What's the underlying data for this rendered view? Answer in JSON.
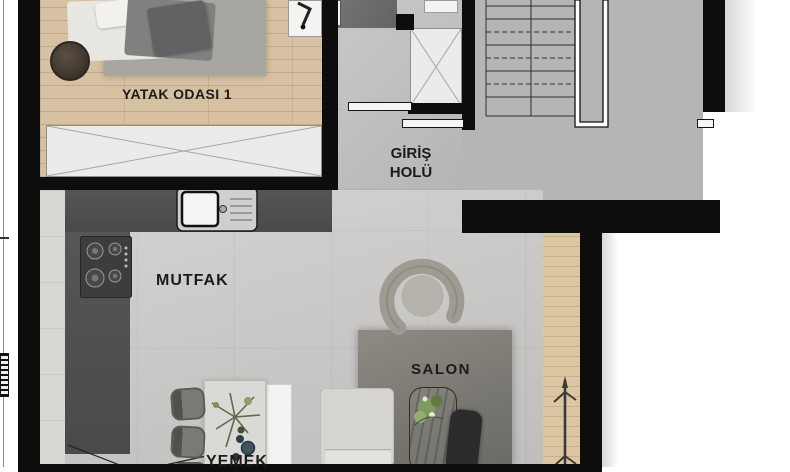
{
  "title": "Apartment floor plan",
  "rooms": {
    "bedroom": {
      "label": "YATAK ODASI 1"
    },
    "hall": {
      "line1": "GİRİŞ",
      "line2": "HOLÜ"
    },
    "kitchen": {
      "label": "MUTFAK"
    },
    "living": {
      "label": "SALON"
    },
    "dining": {
      "label": "YEMEK"
    }
  },
  "furniture": [
    "bed",
    "bedroom-rug",
    "bedside-table",
    "nightstand",
    "table-lamp",
    "wardrobe",
    "kitchen-counter",
    "kitchen-sink",
    "cooktop",
    "entrance-mat",
    "entrance-closet",
    "washer",
    "stairs",
    "stair-railing",
    "sliding-door",
    "dining-table",
    "dining-chair",
    "plant",
    "bench",
    "sofa",
    "armchair",
    "salon-rug",
    "coffee-table",
    "side-chair",
    "coat-rack",
    "balcony-deck",
    "radiator"
  ],
  "colors": {
    "wall": "#0d0d0d",
    "wood_floor": "#d7c1a3",
    "balcony_wood": "#dcc7a2",
    "tile_floor": "#c9c8c6",
    "hall_tile": "#c1c0be",
    "stair_floor": "#b6b5b3",
    "rug_bedroom": "#a8a6a0",
    "rug_salon": "#7d7b75",
    "counter": "#4f4f4f",
    "text": "#1b1b1b"
  }
}
